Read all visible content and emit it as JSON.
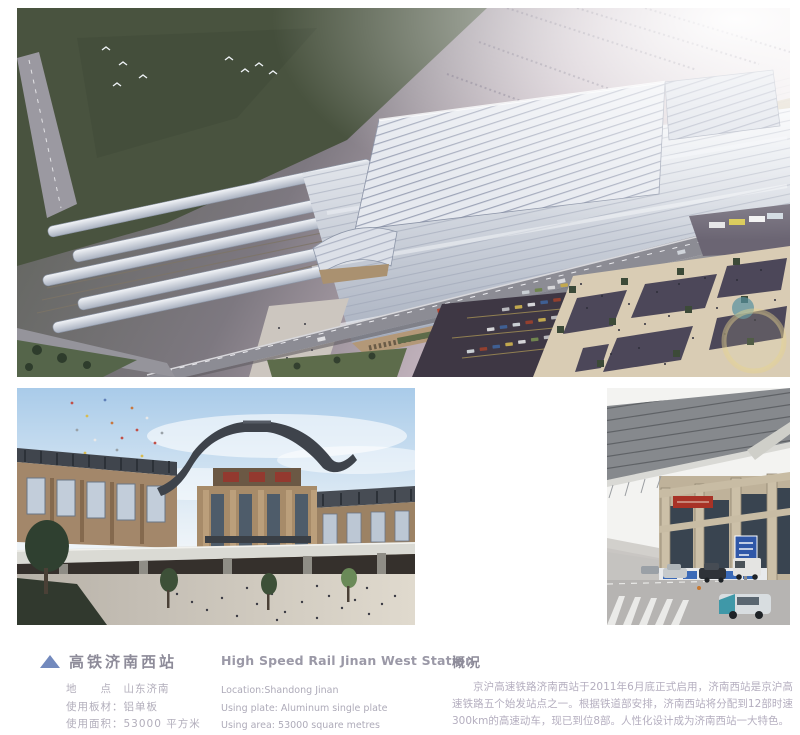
{
  "info": {
    "title_zh": "高铁济南西站",
    "title_en": "High Speed Rail Jinan West Station",
    "details_zh": [
      "地　　点　山东济南",
      "使用板材：铝单板",
      "使用面积：53000 平方米"
    ],
    "details_en": [
      "Location:Shandong Jinan",
      "Using plate: Aluminum single plate",
      "Using area: 53000 square metres"
    ]
  },
  "overview": {
    "heading": "概况",
    "body": "京沪高速铁路济南西站于2011年6月底正式启用，济南西站是京沪高速铁路五个始发站点之一。根据铁道部安排，济南西站将分配到12部时速300km的高速动车，现已到位8部。人性化设计成为济南西站一大特色。"
  },
  "icons": {
    "title_marker": "triangle-up"
  },
  "colors": {
    "page_bg": "#ffffff",
    "accent_triangle": "#7289bd",
    "title_text": "#8d8b99",
    "body_text": "#b2aebb",
    "red_sign": "#a83226"
  }
}
